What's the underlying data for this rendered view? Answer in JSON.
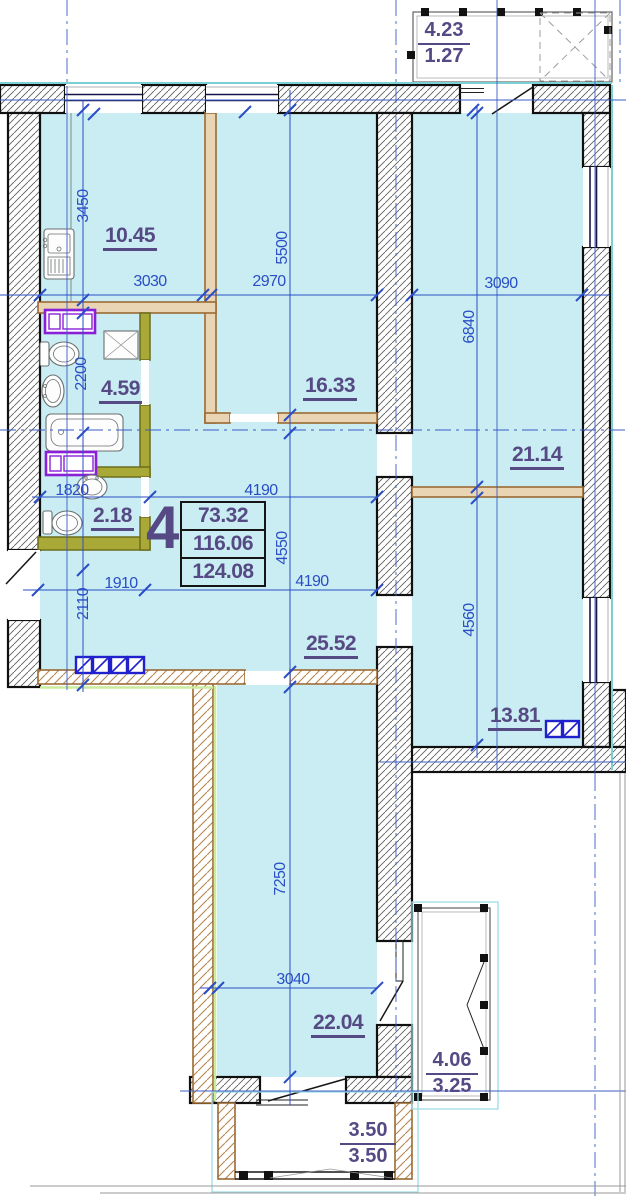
{
  "apartment": {
    "number": "4",
    "area_values": [
      "73.32",
      "116.06",
      "124.08"
    ]
  },
  "rooms": {
    "kitchen": "10.45",
    "living_room": "16.33",
    "bathroom": "4.59",
    "wc": "2.18",
    "hallway": "25.52",
    "bedroom_top_right": "21.14",
    "bedroom_right": "13.81",
    "bedroom_bottom": "22.04"
  },
  "balconies": {
    "top": {
      "full": "4.23",
      "reduced": "1.27"
    },
    "right": {
      "full": "4.06",
      "reduced": "3.25"
    },
    "bottom": {
      "full": "3.50",
      "reduced": "3.50"
    }
  },
  "dimensions_mm": {
    "d3450": "3450",
    "d3030": "3030",
    "d2970": "2970",
    "d5500": "5500",
    "d3090": "3090",
    "d6840": "6840",
    "d2200": "2200",
    "d1820": "1820",
    "d4190a": "4190",
    "d4550": "4550",
    "d1910": "1910",
    "d4190b": "4190",
    "d2110": "2110",
    "d4560": "4560",
    "d7250": "7250",
    "d3040": "3040"
  },
  "colors": {
    "interior_fill": "#c9edf2",
    "dimension_blue": "#2a4ec6",
    "label_purple": "#564a85",
    "partition_tan": "#e9d4b3",
    "partition_olive": "#a9a938",
    "appliance_purple": "#8b1fd8",
    "vent_blue": "#2020cc",
    "accent_teal": "#7ccfd2",
    "accent_green": "#c9ec9e"
  }
}
